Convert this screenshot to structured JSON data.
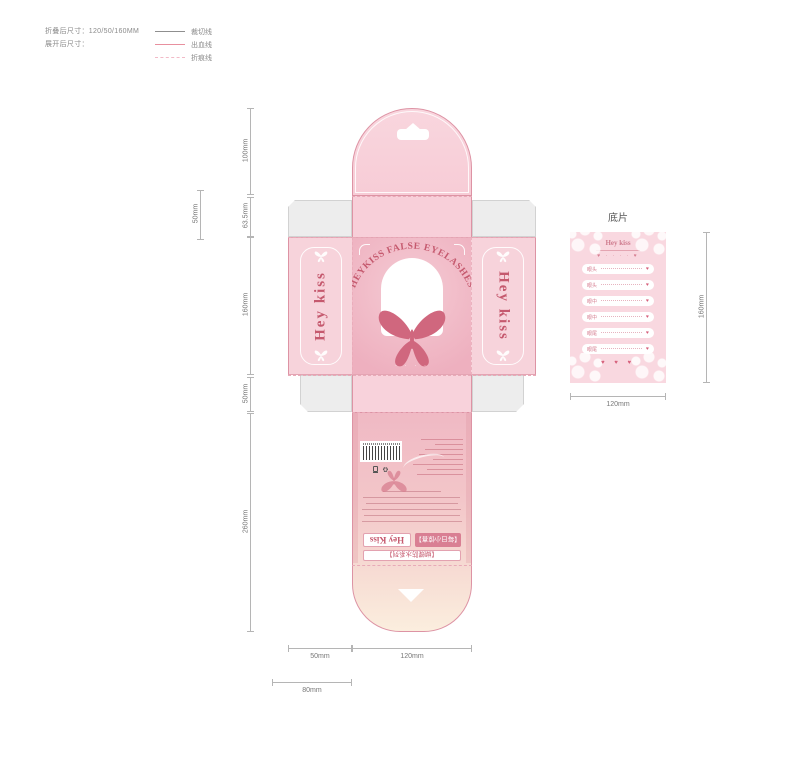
{
  "legend": {
    "folded_label": "折叠后尺寸：120/50/160MM",
    "unfolded_label": "展开后尺寸：",
    "lines": [
      {
        "label": "裁切线",
        "color": "#8f8f8f",
        "style": "solid"
      },
      {
        "label": "出血线",
        "color": "#e8909f",
        "style": "solid"
      },
      {
        "label": "折痕线",
        "color": "#f2bac7",
        "style": "dashed"
      }
    ]
  },
  "colors": {
    "accent_pink": "#c5596e",
    "panel_pink": "#f7d3db",
    "badge_pink": "#d97f93",
    "flap_gray": "#ededed"
  },
  "front": {
    "arch_text": "HEYKISS FALSE EYELASHES",
    "left_panel_brand": "Hey kiss",
    "right_panel_brand": "Hey kiss",
    "dots": "· · · ·"
  },
  "back": {
    "brand": "Hey Kiss",
    "badge_daily": "【每日小惊喜】",
    "badge_series": "【蝴蝶防水系列】"
  },
  "dimensions": {
    "left_col": [
      "100mm",
      "63.5mm",
      "160mm",
      "50mm",
      "260mm"
    ],
    "flap_height": "50mm",
    "bottom_side": "50mm",
    "bottom_center": "120mm",
    "bottom_tab": "80mm"
  },
  "base_card": {
    "title": "底片",
    "brand": "Hey kiss",
    "hearts_top": "♥ · · · · ♥",
    "hearts_bottom": "♥ ♥ ♥",
    "heart_icon": "♥",
    "rows": [
      {
        "label": "眼头"
      },
      {
        "label": "眼头"
      },
      {
        "label": "眼中"
      },
      {
        "label": "眼中"
      },
      {
        "label": "眼尾"
      },
      {
        "label": "眼尾"
      }
    ],
    "width_label": "120mm",
    "height_label": "160mm"
  }
}
